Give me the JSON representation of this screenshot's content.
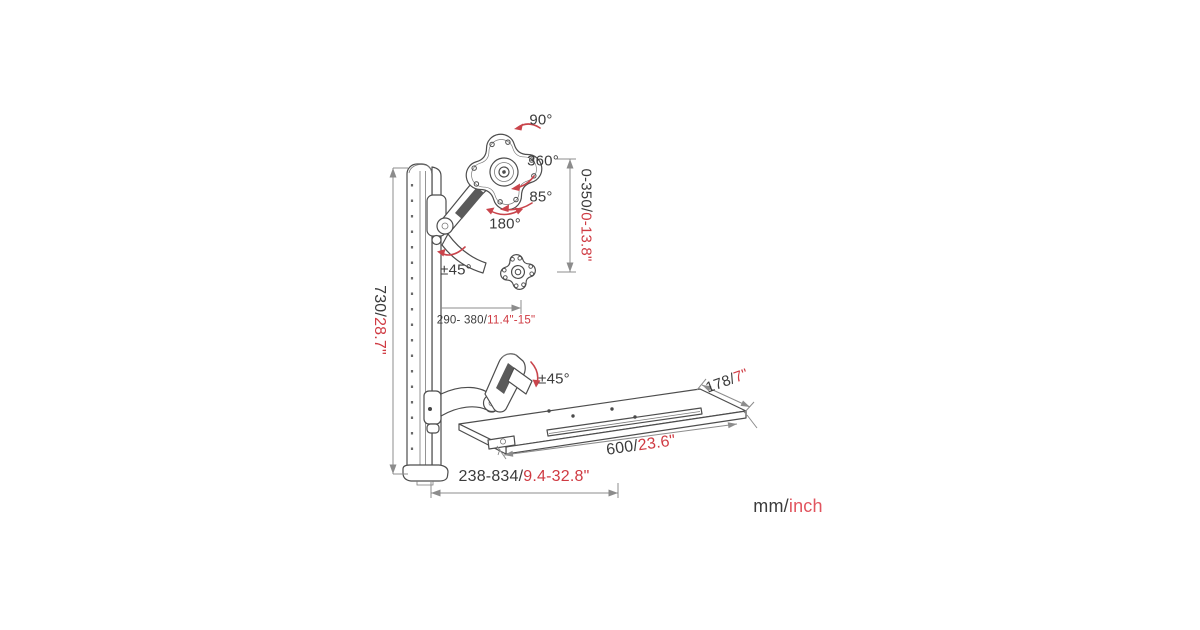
{
  "colors": {
    "line_art": "#4d4d4d",
    "dimension_lines": "#8c8c8c",
    "text_dark": "#3b3b3b",
    "imperial_red": "#cf3a42",
    "legend_red": "#e1545e"
  },
  "angles": {
    "monitor_roll": "90°",
    "monitor_rotation": "360°",
    "monitor_tilt": "85°",
    "arm_swivel": "180°",
    "monitor_arm_tilt": "±45°",
    "keyboard_arm_tilt": "±45°"
  },
  "dimensions": {
    "track_height": {
      "mm": "730/",
      "inch": "28.7\""
    },
    "vertical_range": {
      "mm": "0-350/",
      "inch": "0-13.8\""
    },
    "monitor_arm_reach": {
      "mm": "290- 380/",
      "inch": "11.4\"-15\""
    },
    "tray_depth": {
      "mm": "178/",
      "inch": "7\""
    },
    "tray_width": {
      "mm": "600/",
      "inch": "23.6\""
    },
    "horizontal_reach": {
      "mm": "238-834/",
      "inch": "9.4-32.8\""
    }
  },
  "legend": {
    "metric": "mm/",
    "imperial": "inch"
  }
}
